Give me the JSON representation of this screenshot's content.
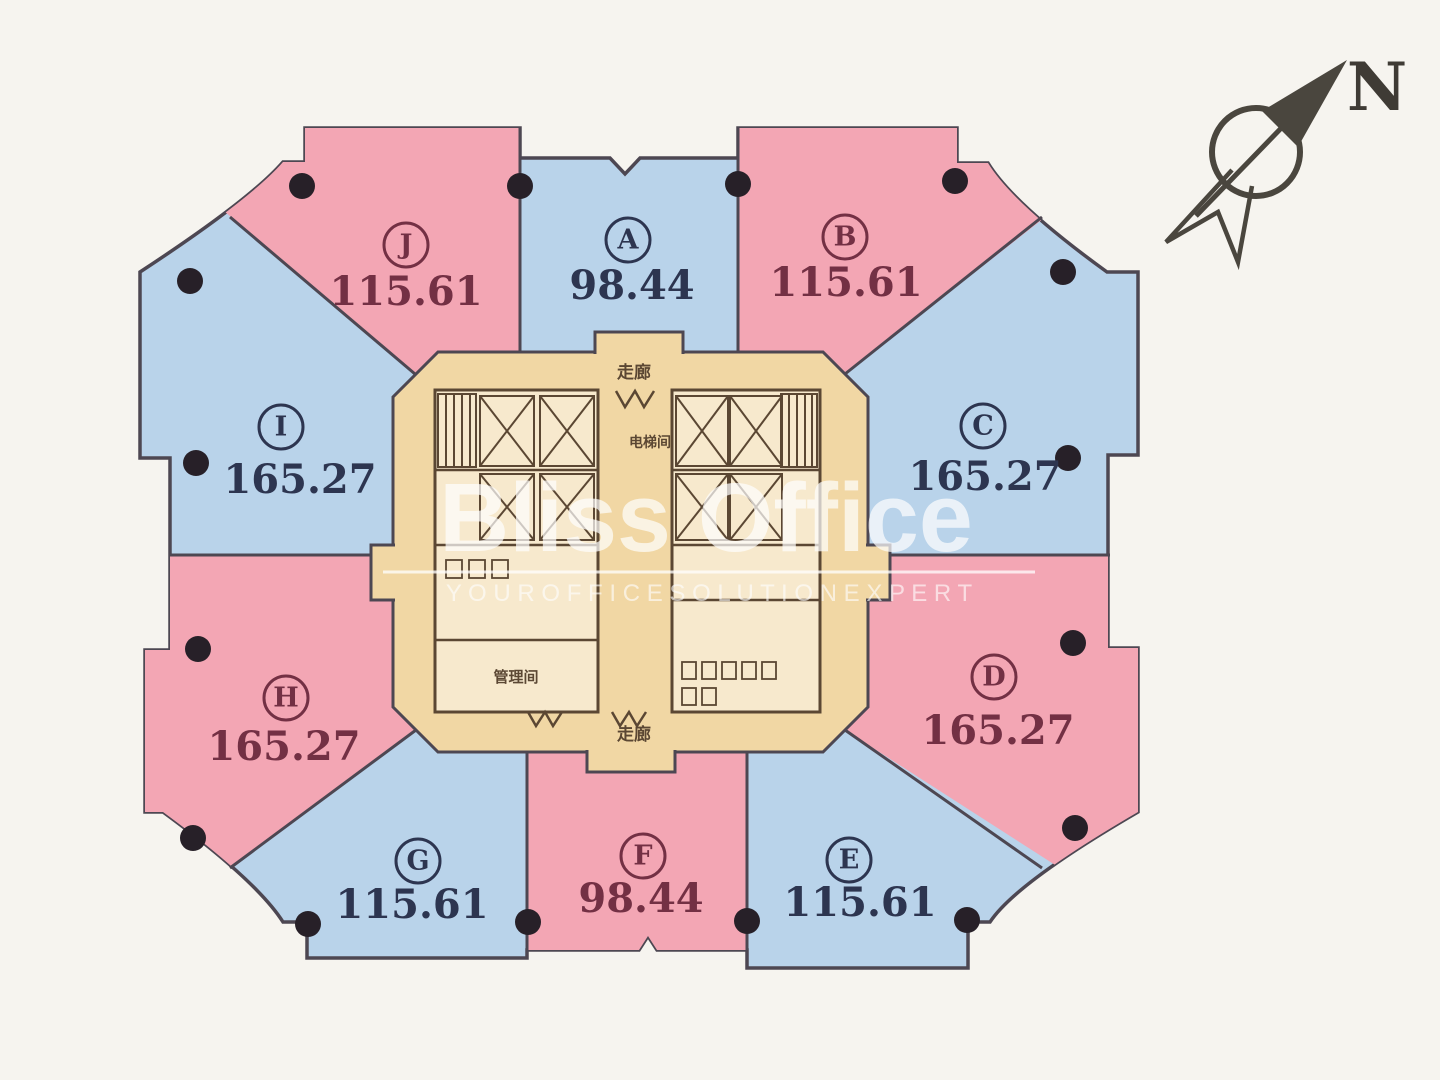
{
  "compass": {
    "label": "N"
  },
  "watermark": {
    "title": "Bliss Office",
    "subtitle": "Y O U R   O F F I C E   S O L U T I O N   E X P E R T"
  },
  "core": {
    "labels": {
      "corridor_top": "走廊",
      "elevator_hall": "电梯间",
      "management_room": "管理间",
      "corridor_bottom": "走廊"
    }
  },
  "units": [
    {
      "letter": "J",
      "area": "115.61",
      "tone": "pink"
    },
    {
      "letter": "A",
      "area": "98.44",
      "tone": "blue"
    },
    {
      "letter": "B",
      "area": "115.61",
      "tone": "pink"
    },
    {
      "letter": "C",
      "area": "165.27",
      "tone": "blue"
    },
    {
      "letter": "D",
      "area": "165.27",
      "tone": "pink"
    },
    {
      "letter": "E",
      "area": "115.61",
      "tone": "blue"
    },
    {
      "letter": "F",
      "area": "98.44",
      "tone": "pink"
    },
    {
      "letter": "G",
      "area": "115.61",
      "tone": "blue"
    },
    {
      "letter": "H",
      "area": "165.27",
      "tone": "pink"
    },
    {
      "letter": "I",
      "area": "165.27",
      "tone": "blue"
    }
  ],
  "colors": {
    "pink": "#f3a6b4",
    "blue": "#b9d3ea",
    "pink_text": "#733044",
    "blue_text": "#2d3550",
    "outline": "#4d4752",
    "core_fill": "#f1d7a4",
    "core_room": "#f7e9cd",
    "core_wall": "#5b4733",
    "dot": "#272028",
    "compass_ink": "#4a463e",
    "background": "#f6f4ef",
    "watermark_white": "#ffffff"
  }
}
